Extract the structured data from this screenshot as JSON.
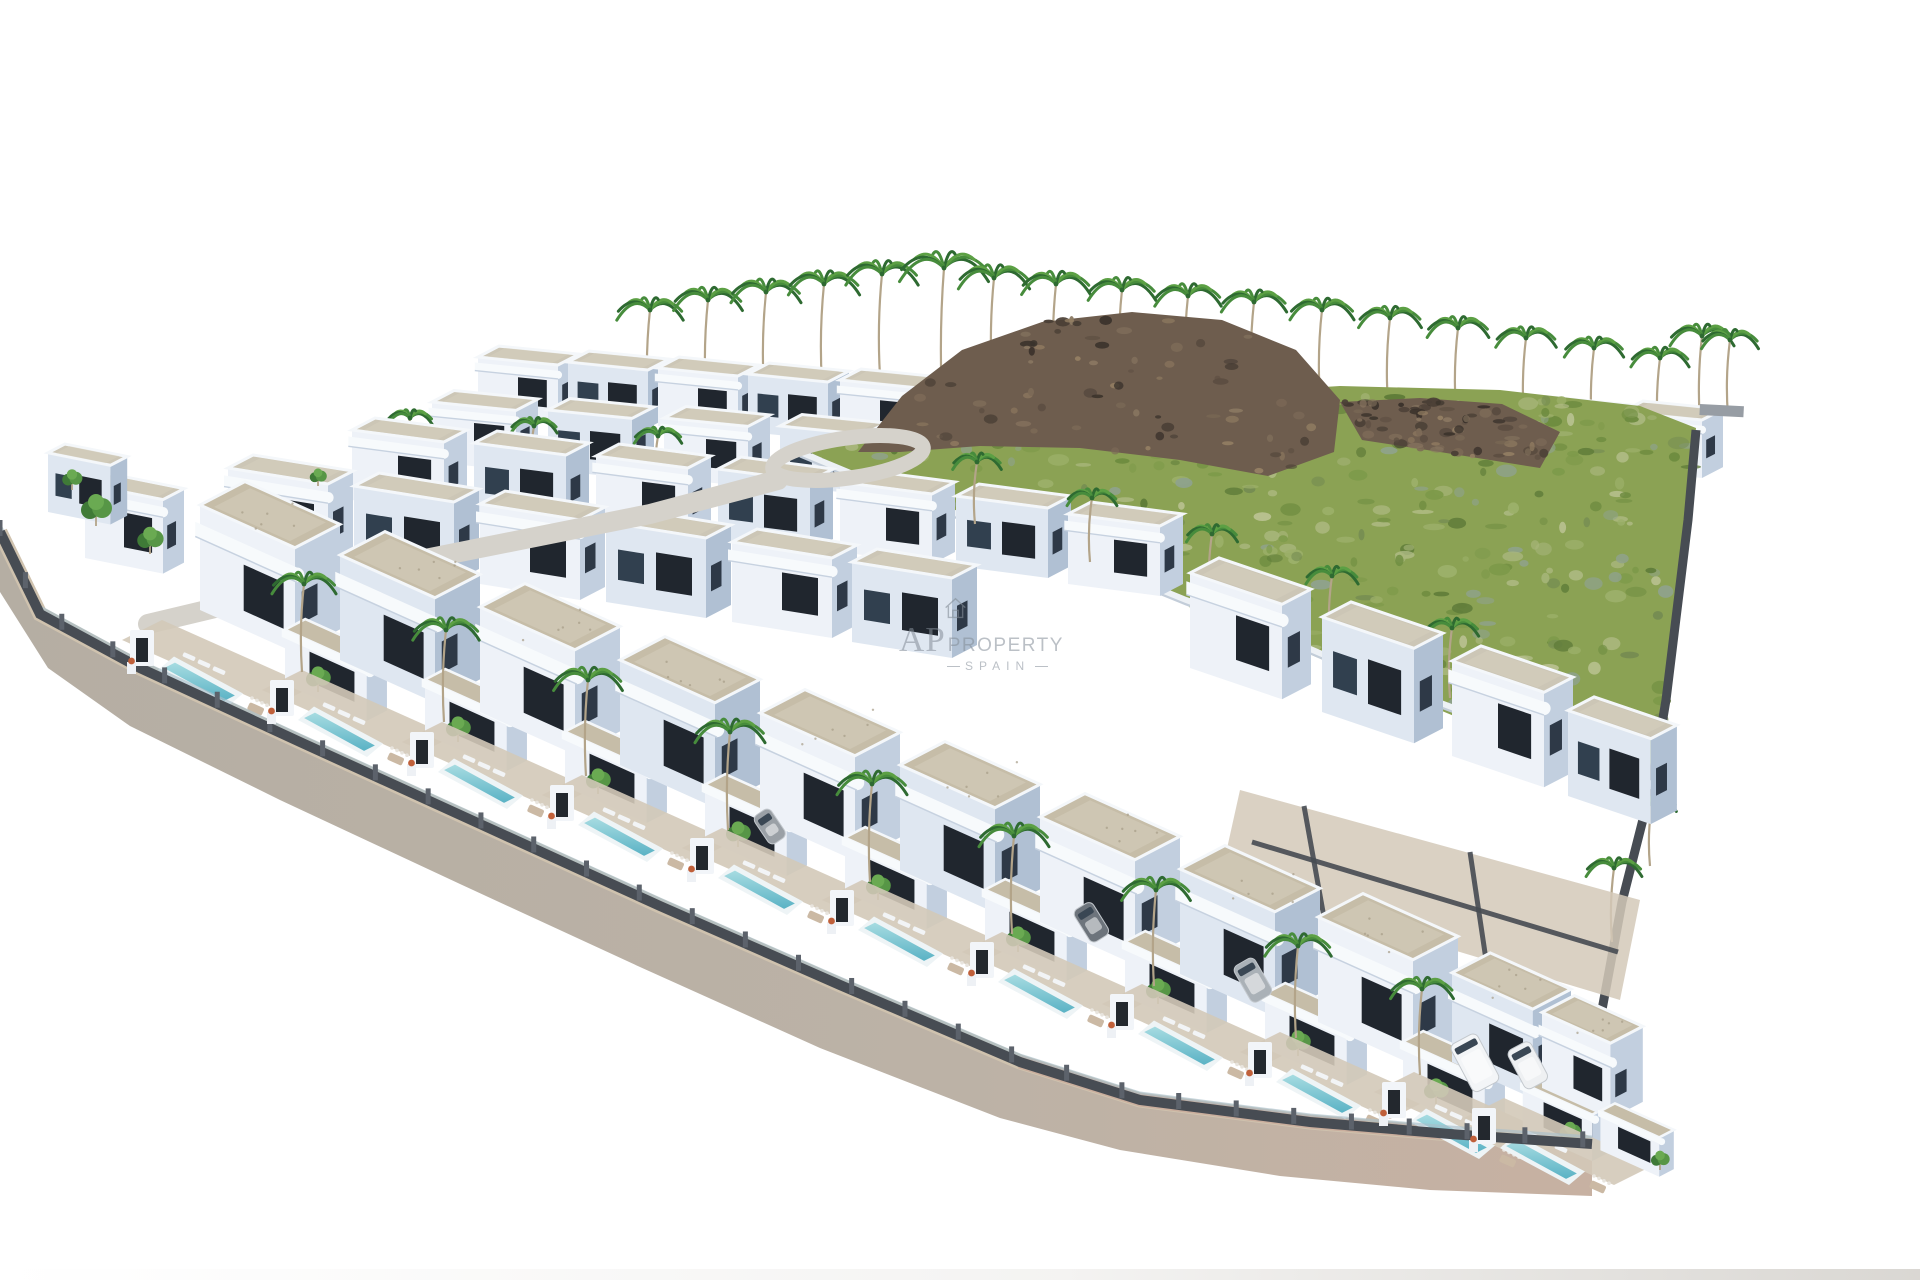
{
  "watermark": {
    "line1": "AP",
    "line2": "PROPERTY",
    "line3": "SPAIN",
    "color": "#848d98",
    "opacity": 0.55
  },
  "scene": {
    "background": "#ffffff",
    "palette": {
      "villaFront": "#eef2f8",
      "villaFrontShade": "#dfe7f1",
      "villaSide": "#c2cfdf",
      "villaSideDark": "#b0c0d3",
      "windowDark": "#20262e",
      "windowBlue": "#2e3947",
      "windowAlt": "#31404f",
      "roofGravel": "#c6bda8",
      "roofGravelBack": "#ccc6b6",
      "roofLight": "#d6cfbd",
      "parapet": "#f4f7fa",
      "band": "#f7fafc",
      "bandShadow": "#c7d2e0",
      "fieldBase": "#8ba254",
      "fieldBlobs": [
        "#6e8c40",
        "#7d9a4a",
        "#9cb06a",
        "#a9b77d",
        "#8fa28b",
        "#5f7c39",
        "#b7c08e",
        "#768d52"
      ],
      "rockBase": "#6e5d4e",
      "rockBlobs": [
        "#5a4c40",
        "#7c6a57",
        "#8a7862",
        "#4a3f36",
        "#958064",
        "#3a322b"
      ],
      "road": "#b5aea3",
      "roadWarm": "#c7b1a2",
      "sidewalk": "#cfc2ae",
      "sidewalkPink": "#c79f8f",
      "wall": "#474c53",
      "wallLight": "#5c626b",
      "balustrade": "#a9bfca",
      "street": "#d5d2cb",
      "pool1": "#a9dde2",
      "pool2": "#58b1c4",
      "poolRim": "#eef4f6",
      "terrace": "#d3c9b8",
      "palm": [
        "#2e6a31",
        "#478c3c",
        "#5ca044"
      ],
      "trunk": "#b3a489",
      "tree": [
        "#3f7a37",
        "#579646",
        "#6aaa52"
      ],
      "retWall": "#edf1f5",
      "retWallShadow": "#c3cdd9",
      "pier": "#979da4",
      "doorway": "#23282e",
      "planterFlower": "#c0603a"
    },
    "roads": {
      "inner": [
        [
          0,
          532
        ],
        [
          40,
          614
        ],
        [
          140,
          668
        ],
        [
          300,
          742
        ],
        [
          480,
          824
        ],
        [
          660,
          906
        ],
        [
          840,
          985
        ],
        [
          1020,
          1062
        ],
        [
          1140,
          1100
        ],
        [
          1310,
          1122
        ],
        [
          1450,
          1134
        ],
        [
          1592,
          1144
        ]
      ],
      "outer": [
        [
          1592,
          1196
        ],
        [
          1430,
          1190
        ],
        [
          1280,
          1176
        ],
        [
          1120,
          1150
        ],
        [
          1000,
          1118
        ],
        [
          820,
          1048
        ],
        [
          640,
          967
        ],
        [
          460,
          884
        ],
        [
          280,
          800
        ],
        [
          130,
          726
        ],
        [
          48,
          668
        ],
        [
          0,
          592
        ]
      ]
    },
    "street": {
      "path": [
        [
          148,
          624
        ],
        [
          400,
          564
        ],
        [
          650,
          514
        ],
        [
          778,
          480
        ]
      ],
      "loop": {
        "cx": 848,
        "cy": 458,
        "rx": 76,
        "ry": 20,
        "rot": -8
      }
    },
    "field": {
      "polygon": [
        [
          800,
          448
        ],
        [
          900,
          424
        ],
        [
          1020,
          408
        ],
        [
          1180,
          396
        ],
        [
          1340,
          386
        ],
        [
          1500,
          390
        ],
        [
          1640,
          406
        ],
        [
          1696,
          428
        ],
        [
          1688,
          520
        ],
        [
          1666,
          700
        ],
        [
          1652,
          784
        ],
        [
          1560,
          760
        ],
        [
          1430,
          706
        ],
        [
          1300,
          650
        ],
        [
          1180,
          600
        ],
        [
          1060,
          552
        ],
        [
          950,
          510
        ],
        [
          862,
          476
        ]
      ],
      "blobCount": 330,
      "seed": 7
    },
    "rocks": {
      "polygons": [
        [
          [
            858,
            452
          ],
          [
            902,
            396
          ],
          [
            962,
            350
          ],
          [
            1042,
            322
          ],
          [
            1132,
            312
          ],
          [
            1222,
            320
          ],
          [
            1296,
            350
          ],
          [
            1340,
            400
          ],
          [
            1334,
            452
          ],
          [
            1268,
            476
          ],
          [
            1180,
            460
          ],
          [
            1080,
            448
          ],
          [
            980,
            446
          ],
          [
            900,
            452
          ]
        ],
        [
          [
            1340,
            402
          ],
          [
            1420,
            398
          ],
          [
            1502,
            404
          ],
          [
            1560,
            432
          ],
          [
            1540,
            468
          ],
          [
            1440,
            452
          ],
          [
            1362,
            440
          ]
        ]
      ],
      "blobCount": 150,
      "seed": 13
    },
    "retainingWall": [
      [
        800,
        452
      ],
      [
        848,
        472
      ],
      [
        872,
        482
      ],
      [
        916,
        500
      ],
      [
        958,
        514
      ],
      [
        1012,
        538
      ],
      [
        1066,
        554
      ],
      [
        1122,
        574
      ],
      [
        1186,
        600
      ],
      [
        1252,
        624
      ],
      [
        1322,
        654
      ],
      [
        1396,
        686
      ],
      [
        1470,
        714
      ],
      [
        1546,
        744
      ],
      [
        1620,
        772
      ],
      [
        1652,
        784
      ]
    ],
    "rightBoundary": [
      [
        1696,
        430
      ],
      [
        1688,
        520
      ],
      [
        1666,
        700
      ],
      [
        1652,
        784
      ],
      [
        1622,
        902
      ],
      [
        1596,
        1042
      ],
      [
        1590,
        1143
      ]
    ],
    "pier": {
      "x": 1700,
      "y": 404,
      "w": 44,
      "h": 11
    },
    "rightYard": {
      "polygon": [
        [
          1240,
          790
        ],
        [
          1640,
          900
        ],
        [
          1620,
          1000
        ],
        [
          1220,
          880
        ]
      ],
      "walls": [
        [
          [
            1252,
            842
          ],
          [
            1618,
            952
          ]
        ],
        [
          [
            1304,
            806
          ],
          [
            1332,
            962
          ]
        ],
        [
          [
            1470,
            852
          ],
          [
            1492,
            1000
          ]
        ]
      ]
    },
    "rows": [
      {
        "name": "row-back",
        "w": 80,
        "h": 58,
        "d": 42,
        "s": 0.1,
        "kind": "simple",
        "anchors": [
          [
            478,
            415
          ],
          [
            568,
            420
          ],
          [
            658,
            426
          ],
          [
            748,
            432
          ],
          [
            840,
            438
          ],
          [
            933,
            443
          ],
          [
            1028,
            448
          ],
          [
            1126,
            452
          ],
          [
            1226,
            456
          ],
          [
            1328,
            459
          ],
          [
            1430,
            462
          ],
          [
            1530,
            466
          ],
          [
            1622,
            470
          ]
        ]
      },
      {
        "name": "row-back-2",
        "w": 84,
        "h": 60,
        "d": 44,
        "s": 0.1,
        "kind": "simple",
        "anchors": [
          [
            432,
            462
          ],
          [
            548,
            470
          ],
          [
            664,
            478
          ],
          [
            780,
            486
          ]
        ]
      },
      {
        "name": "row-mid-a",
        "w": 92,
        "h": 70,
        "d": 46,
        "s": 0.13,
        "kind": "simple",
        "anchors": [
          [
            352,
            500
          ],
          [
            474,
            513
          ],
          [
            596,
            526
          ],
          [
            718,
            539
          ],
          [
            840,
            552
          ],
          [
            956,
            566
          ],
          [
            1068,
            584
          ]
        ]
      },
      {
        "name": "row-mid-b",
        "w": 100,
        "h": 80,
        "d": 50,
        "s": 0.16,
        "kind": "simple",
        "anchors": [
          [
            228,
            548
          ],
          [
            354,
            566
          ],
          [
            480,
            584
          ],
          [
            606,
            602
          ],
          [
            732,
            622
          ],
          [
            852,
            642
          ]
        ]
      },
      {
        "name": "row-left",
        "w": 78,
        "h": 74,
        "d": 42,
        "s": 0.2,
        "kind": "simple",
        "anchors": [
          [
            85,
            558
          ],
          [
            48,
            512,
            0.8
          ]
        ]
      },
      {
        "name": "row-right-mid",
        "w": 92,
        "h": 95,
        "d": 58,
        "s": 0.34,
        "kind": "simple",
        "anchors": [
          [
            1190,
            668
          ],
          [
            1322,
            712
          ],
          [
            1452,
            756
          ],
          [
            1568,
            796,
            0.9
          ]
        ]
      },
      {
        "name": "row-front",
        "w": 95,
        "h": 105,
        "d": 90,
        "s": 0.45,
        "kind": "step",
        "anchors": [
          [
            200,
            610
          ],
          [
            340,
            660
          ],
          [
            480,
            712
          ],
          [
            620,
            765
          ],
          [
            760,
            818
          ],
          [
            900,
            870
          ],
          [
            1040,
            922
          ],
          [
            1180,
            974
          ],
          [
            1318,
            1022
          ],
          [
            1452,
            1062,
            0.85
          ],
          [
            1542,
            1088,
            0.72
          ]
        ]
      }
    ],
    "palms": {
      "back": [
        [
          648,
          402,
          92
        ],
        [
          706,
          396,
          96
        ],
        [
          764,
          390,
          98
        ],
        [
          822,
          384,
          100
        ],
        [
          880,
          376,
          102
        ],
        [
          942,
          398,
          130
        ],
        [
          992,
          378,
          100
        ],
        [
          1054,
          380,
          96
        ],
        [
          1120,
          384,
          94
        ],
        [
          1186,
          388,
          92
        ],
        [
          1252,
          392,
          90
        ],
        [
          1320,
          398,
          88
        ],
        [
          1388,
          404,
          86
        ],
        [
          1456,
          412,
          84
        ],
        [
          1524,
          420,
          82
        ],
        [
          1592,
          428,
          80
        ],
        [
          1658,
          436,
          78
        ],
        [
          1700,
          424,
          88
        ],
        [
          1728,
          416,
          76
        ]
      ],
      "mid": [
        [
          408,
          474,
          56
        ],
        [
          532,
          484,
          58
        ],
        [
          656,
          496,
          60
        ],
        [
          340,
          536,
          50
        ]
      ],
      "mid2": [
        [
          300,
          556,
          50
        ],
        [
          430,
          572,
          52
        ],
        [
          560,
          590,
          54
        ],
        [
          690,
          608,
          56
        ],
        [
          820,
          626,
          58
        ]
      ],
      "field": [
        [
          975,
          524,
          62
        ],
        [
          1090,
          562,
          64
        ],
        [
          1210,
          600,
          66
        ],
        [
          1330,
          644,
          68
        ],
        [
          1450,
          698,
          70
        ],
        [
          1612,
          942,
          74
        ],
        [
          1650,
          866,
          62
        ]
      ],
      "front": [
        [
          302,
          672,
          88
        ],
        [
          444,
          722,
          92
        ],
        [
          586,
          776,
          96
        ],
        [
          728,
          830,
          98
        ],
        [
          870,
          882,
          98
        ],
        [
          1012,
          934,
          98
        ],
        [
          1154,
          986,
          96
        ],
        [
          1296,
          1038,
          92
        ],
        [
          1420,
          1075,
          86
        ]
      ]
    },
    "trees": [
      [
        96,
        526,
        1.0
      ],
      [
        150,
        554,
        0.85
      ],
      [
        224,
        592,
        0.8
      ],
      [
        72,
        490,
        0.65
      ],
      [
        258,
        522,
        0.6
      ],
      [
        318,
        486,
        0.55
      ]
    ],
    "vehicles": [
      {
        "x": 1449,
        "y": 1046,
        "w": 30,
        "l": 54,
        "c": "#f3f5f7",
        "r": -28,
        "k": "van"
      },
      {
        "x": 1506,
        "y": 1052,
        "w": 26,
        "l": 44,
        "c": "#eef0f2",
        "r": -28,
        "k": "van"
      },
      {
        "x": 1232,
        "y": 968,
        "w": 24,
        "l": 42,
        "c": "#aab1b7",
        "r": -30,
        "k": "car"
      },
      {
        "x": 1072,
        "y": 912,
        "w": 22,
        "l": 38,
        "c": "#6d747c",
        "r": -32,
        "k": "car"
      },
      {
        "x": 752,
        "y": 818,
        "w": 20,
        "l": 34,
        "c": "#9aa0a6",
        "r": -34,
        "k": "car"
      }
    ],
    "bottomBand": {
      "y": 1269,
      "h": 11,
      "color": "#d3d0cb"
    }
  }
}
